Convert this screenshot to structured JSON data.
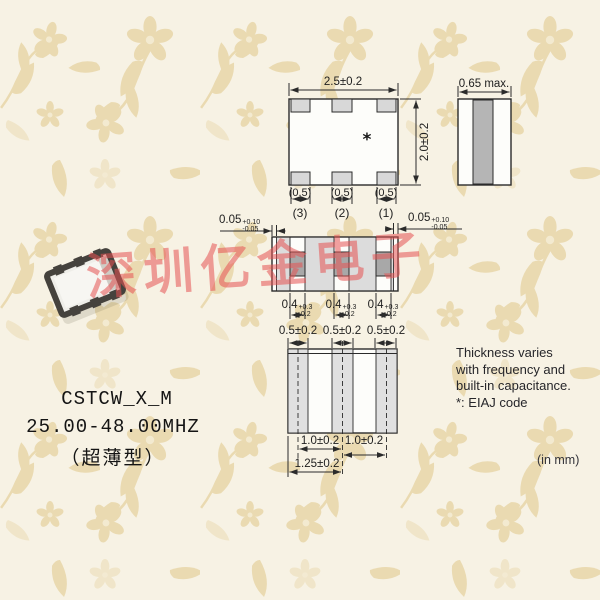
{
  "product": {
    "model": "CSTCW_X_M",
    "frequency_range": "25.00-48.00MHZ",
    "package_note": "（超薄型）"
  },
  "watermark": {
    "text": "深圳亿金电子",
    "color": "#e65252"
  },
  "units_note": "(in mm)",
  "side_note": {
    "lines": [
      "Thickness varies",
      "with frequency and",
      "built-in capacitance.",
      "*: EIAJ code"
    ]
  },
  "top_view": {
    "width": "2.5±0.2",
    "height": "2.0±0.2",
    "pad_widths": [
      "(0.5)",
      "(0.5)",
      "(0.5)"
    ],
    "terminals": [
      "(3)",
      "(2)",
      "(1)"
    ],
    "eiaj_mark": "*"
  },
  "side_view": {
    "thickness": "0.65 max."
  },
  "front_view": {
    "left_margin": {
      "value": "0.05",
      "tol_plus": "+0.10",
      "tol_minus": "-0.05"
    },
    "right_margin": {
      "value": "0.05",
      "tol_plus": "+0.10",
      "tol_minus": "-0.05"
    },
    "electrodes": [
      {
        "value": "0.4",
        "tol_plus": "+0.3",
        "tol_minus": "-0.2"
      },
      {
        "value": "0.4",
        "tol_plus": "+0.3",
        "tol_minus": "-0.2"
      },
      {
        "value": "0.4",
        "tol_plus": "+0.3",
        "tol_minus": "-0.2"
      }
    ]
  },
  "bottom_view": {
    "pad_widths": [
      "0.5±0.2",
      "0.5±0.2",
      "0.5±0.2"
    ],
    "pitches": [
      "1.0±0.2",
      "1.0±0.2"
    ],
    "edge_to_center": "1.25±0.2"
  },
  "colors": {
    "background": "#f7f2e4",
    "pattern_motif": "#e8d6a8",
    "line": "#2b2b2b",
    "pad_fill": "#d8d8d8",
    "stripe_fill": "#b5b5b5",
    "electrode_fill": "#a8a8a8"
  }
}
